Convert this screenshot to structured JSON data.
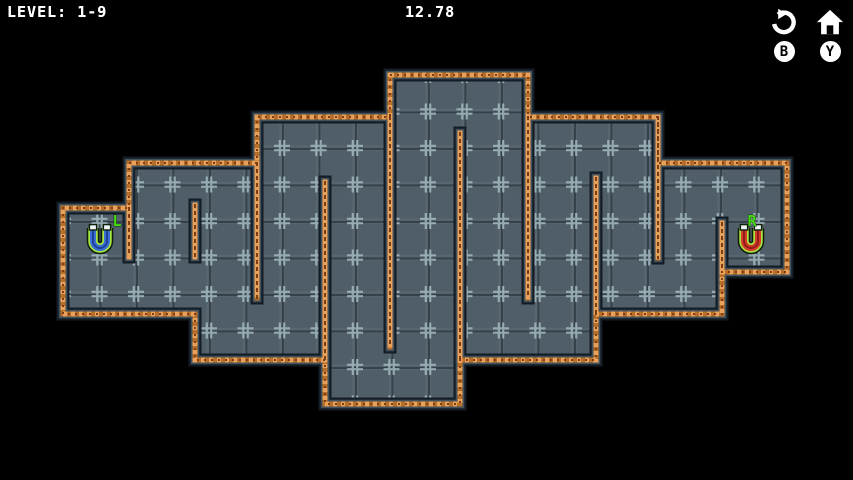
{
  "hud": {
    "level_label": "LEVEL: 1-9",
    "timer": "12.78",
    "buttons": [
      {
        "name": "restart",
        "icon": "restart-icon",
        "badge": "B"
      },
      {
        "name": "home",
        "icon": "home-icon",
        "badge": "Y"
      }
    ]
  },
  "level": {
    "background": "#000000",
    "tile_size": 36.5,
    "tile_origin": [
      63,
      75
    ],
    "palette": {
      "floor": "#4f5e68",
      "floor_seam": "#36414a",
      "floor_mark": "#a7bec6",
      "wall_border": "#141d26",
      "wall_steel": "#41525c",
      "wall_brick": "#b96f28",
      "wall_brick_light": "#e9a058",
      "wall_brick_dark": "#7c3f15"
    },
    "outer_boundary": [
      [
        390,
        75
      ],
      [
        528,
        75
      ],
      [
        528,
        117
      ],
      [
        658,
        117
      ],
      [
        658,
        163
      ],
      [
        787,
        163
      ],
      [
        787,
        272
      ],
      [
        722,
        272
      ],
      [
        722,
        314
      ],
      [
        596,
        314
      ],
      [
        596,
        360
      ],
      [
        460,
        360
      ],
      [
        460,
        404
      ],
      [
        325,
        404
      ],
      [
        325,
        360
      ],
      [
        195,
        360
      ],
      [
        195,
        314
      ],
      [
        63,
        314
      ],
      [
        63,
        208
      ],
      [
        129,
        208
      ],
      [
        129,
        163
      ],
      [
        257,
        163
      ],
      [
        257,
        117
      ],
      [
        390,
        117
      ]
    ],
    "inner_walls": [
      [
        129,
        208,
        129,
        257
      ],
      [
        195,
        205,
        195,
        257
      ],
      [
        257,
        163,
        257,
        298
      ],
      [
        325,
        182,
        325,
        360
      ],
      [
        390,
        117,
        390,
        347
      ],
      [
        460,
        133,
        460,
        360
      ],
      [
        528,
        117,
        528,
        298
      ],
      [
        596,
        178,
        596,
        314
      ],
      [
        658,
        117,
        658,
        258
      ],
      [
        722,
        223,
        722,
        272
      ]
    ],
    "magnets": [
      {
        "id": "left-magnet",
        "label": "L",
        "x": 100,
        "y": 240,
        "label_x": 117,
        "label_y": 226,
        "body_color": "#3a70d6",
        "dark_color": "#1d4099",
        "outline_color": "#a9e440",
        "tip_color": "#eef4f6",
        "label_color": "#44dd11"
      },
      {
        "id": "right-magnet",
        "label": "R",
        "x": 751,
        "y": 240,
        "label_x": 752,
        "label_y": 226,
        "body_color": "#d63a2a",
        "dark_color": "#8e1f16",
        "outline_color": "#a9e440",
        "tip_color": "#eef4f6",
        "label_color": "#44dd11"
      }
    ]
  }
}
